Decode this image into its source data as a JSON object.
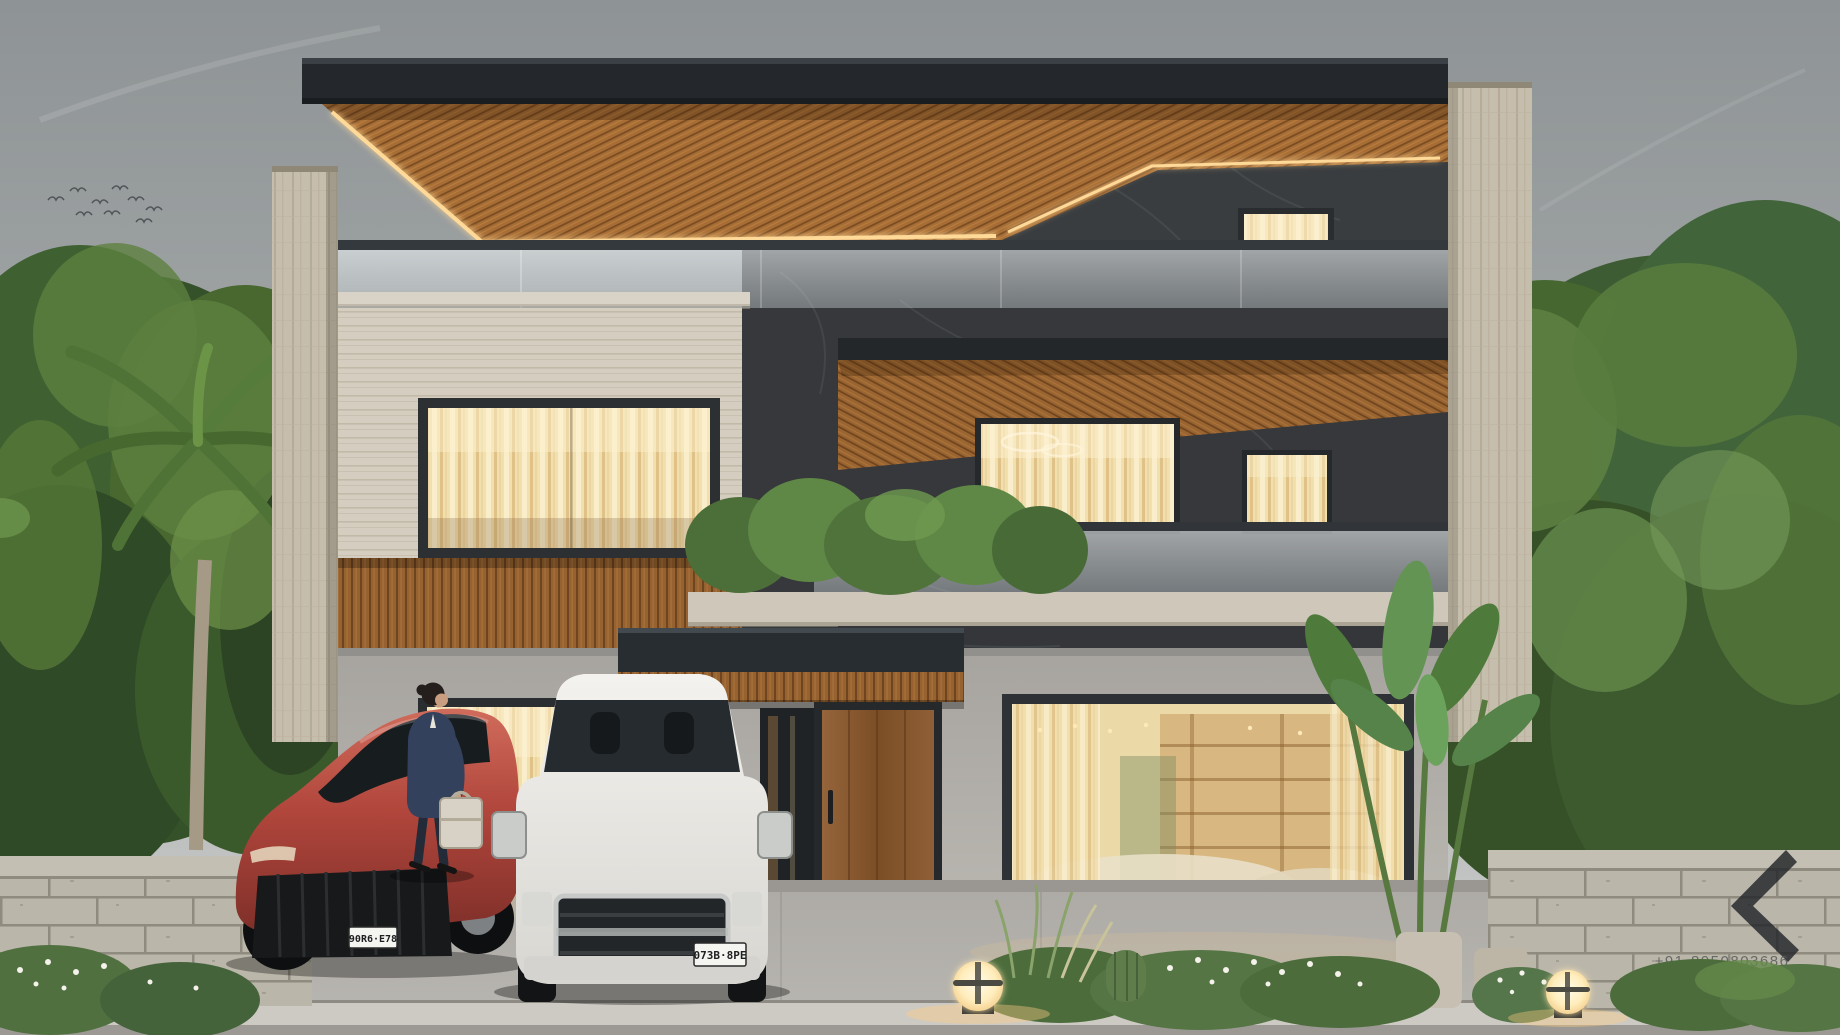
{
  "scene": {
    "subject": "Modern two-storey luxury house exterior, overcast sky, evening warm interior lighting"
  },
  "watermark": {
    "phone": "+91-8950803686",
    "logo": "angular-chevron-K-monogram"
  },
  "plates": {
    "red_car": "90R6·E78",
    "white_truck": "073B·8PE"
  },
  "colors": {
    "sky_top": "#8f9496",
    "sky_bottom": "#cfd0cd",
    "roof_fascia": "#24282c",
    "wood": "#9a6834",
    "wood_dark": "#6b421e",
    "led_glow": "#ffd998",
    "travertine": "#c7bfae",
    "stone_light": "#d3ccbf",
    "marble_dark": "#36383b",
    "stucco": "#aaa7a2",
    "glass": "#ccd4d8",
    "window_warm": "#f3e0b0",
    "foliage": "#47682f",
    "foliage_light": "#6f9a50",
    "block_wall": "#b9b5a9",
    "pavement": "#b3b1ac",
    "curb": "#cfccc5",
    "car_red": "#b14a40",
    "truck_white": "#eceae6",
    "lamp_glow": "#ffe9bd",
    "suit_navy": "#32405c",
    "briefcase": "#d8d2c6"
  }
}
